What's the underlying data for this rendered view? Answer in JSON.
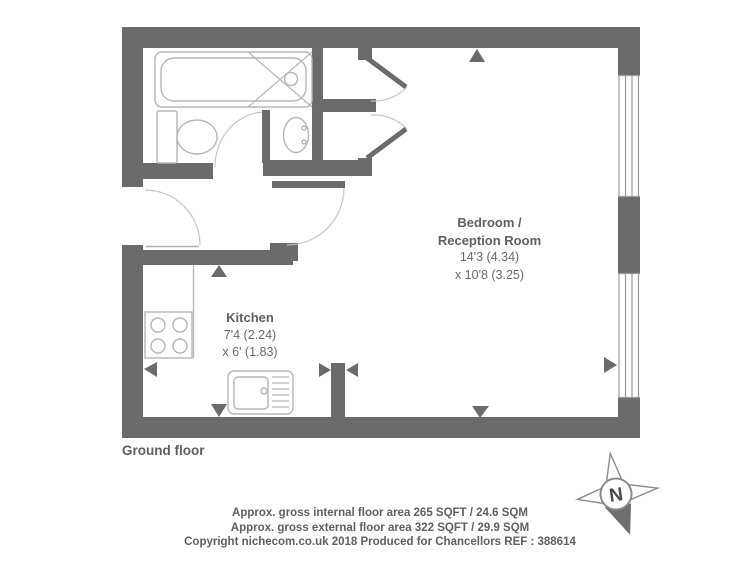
{
  "floor": {
    "label": "Ground floor"
  },
  "rooms": {
    "bedroom": {
      "name_line1": "Bedroom /",
      "name_line2": "Reception Room",
      "dims_line1": "14'3 (4.34)",
      "dims_line2": "x 10'8 (3.25)"
    },
    "kitchen": {
      "name": "Kitchen",
      "dims_line1": "7'4 (2.24)",
      "dims_line2": "x 6' (1.83)"
    }
  },
  "footer": {
    "internal_area": "Approx. gross internal floor area 265 SQFT / 24.6 SQM",
    "external_area": "Approx. gross external floor area 322 SQFT / 29.9 SQM",
    "copyright": "Copyright nichecom.co.uk 2018 Produced for Chancellors REF : 388614"
  },
  "compass": {
    "north_label": "N"
  },
  "colors": {
    "wall": "#6b6b6b",
    "fixture_line": "#b6b6b6",
    "door_arc_line": "#c6c6c6",
    "text": "#5f5f5f"
  }
}
